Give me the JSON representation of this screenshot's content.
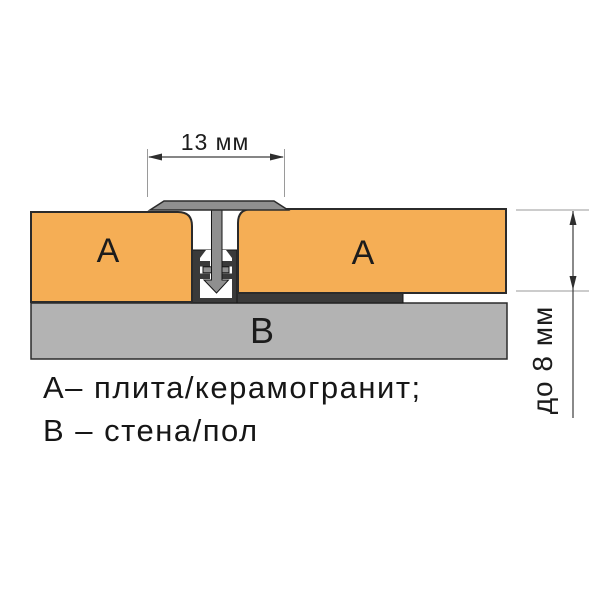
{
  "diagram": {
    "title": "T-profile tile joint cross-section",
    "dim_top": "13 мм",
    "dim_right": "до 8 мм",
    "label_tile_left": "A",
    "label_tile_right": "A",
    "label_base": "B",
    "legend_line1": "A– плита/керамогранит;",
    "legend_line2": "B – стена/пол"
  },
  "colors": {
    "background": "#FFFFFF",
    "tile": "#F5AE55",
    "profile_cap": "#8F8F8F",
    "profile_base": "#3A3A3A",
    "cavity": "#FFFFFF",
    "substrate": "#B3B3B3"
  }
}
